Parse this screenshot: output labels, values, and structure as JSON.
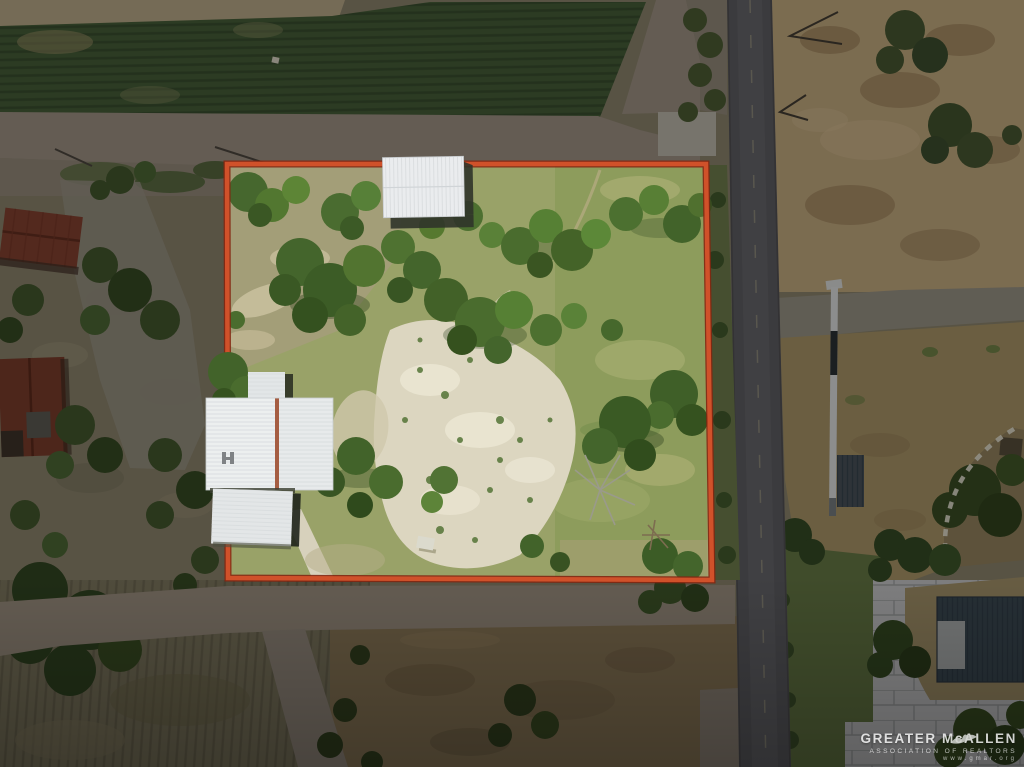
{
  "page": {
    "kind": "aerial-property-listing-photo",
    "width_px": 1024,
    "height_px": 767
  },
  "listing_overlay": {
    "boundary_shape": "rectangle",
    "boundary_color": "#d0512a",
    "boundary_edge_color": "#832611",
    "outside_dimmed": true
  },
  "watermark": {
    "org_name": "GREATER McALLEN",
    "org_subtitle": "ASSOCIATION OF REALTORS",
    "org_url": "www.gmar.org",
    "logo": "dove-icon",
    "text_color": "#ffffff"
  },
  "scene": {
    "features": [
      "crop-field",
      "farm-dirt-roads",
      "outlined-vacant-lot",
      "main-house-metal-roof",
      "storage-shed-metal-roof",
      "rust-roof-barns",
      "sandy-clearing",
      "tree-clusters",
      "paved-road",
      "utility-pole-shadows",
      "neighbor-dirt-field",
      "neighbor-lawn",
      "stepping-stone-path",
      "neighbor-navy-roof-home",
      "paver-courtyard"
    ]
  },
  "palette": {
    "crop_field_green": "#3f5733",
    "dirt_road_gray": "#95897d",
    "asphalt_road": "#57565c",
    "lot_grass": "#8d9c5c",
    "lot_sand": "#dcd6c0",
    "tree_green": "#44652c",
    "white_metal_roof": "#e7eaeb",
    "rust_barn_roof": "#7c3b2b",
    "navy_roof": "#37444f",
    "paver_gray": "#bdbec0",
    "dead_lawn_tan": "#a08c62"
  }
}
